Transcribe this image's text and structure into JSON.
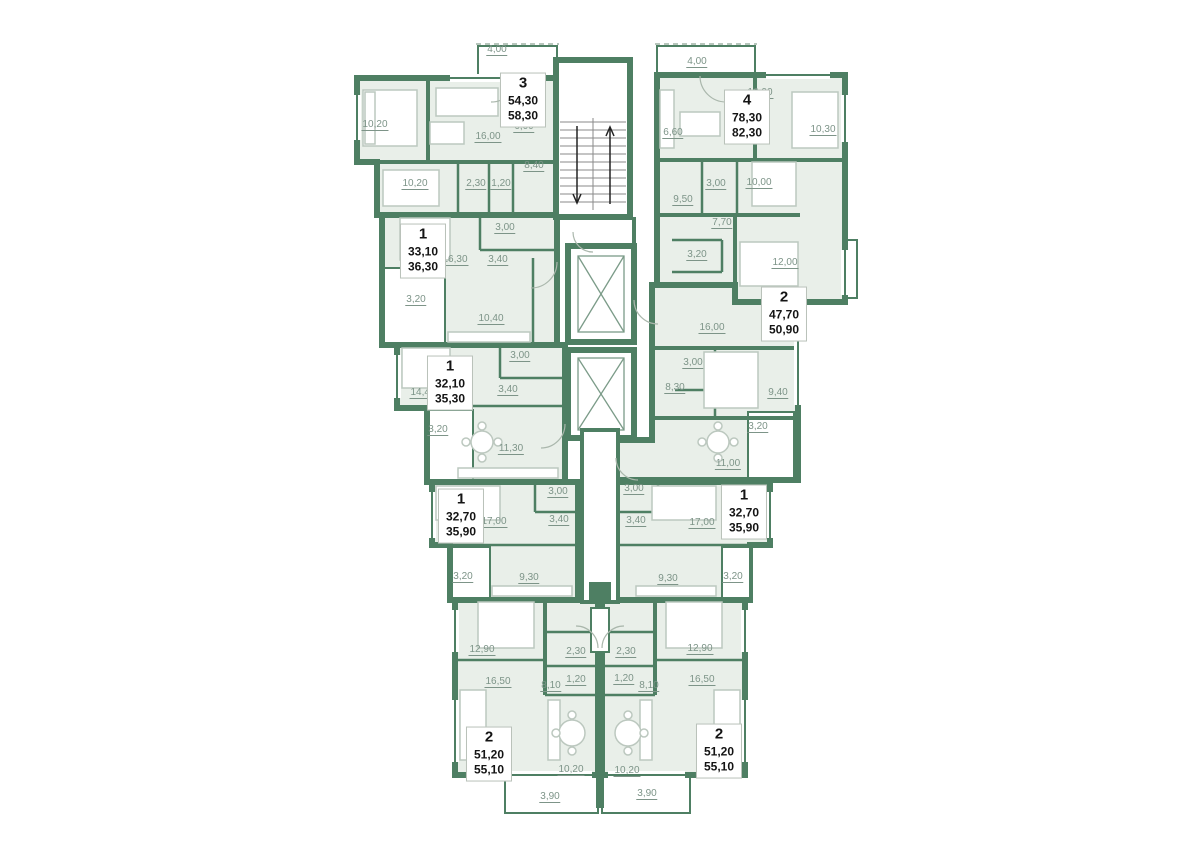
{
  "plan_title": "residential-floor-plan",
  "colors": {
    "wall": "#4e7f63",
    "room_fill": "#e9efe9",
    "dimension_text": "#7d9488",
    "label_text": "#141414",
    "label_background": "#ffffff",
    "furniture": "#bcc8bf"
  },
  "apartments": [
    {
      "number": "3",
      "area_living": "54,30",
      "area_total": "58,30",
      "x": 523,
      "y": 100
    },
    {
      "number": "4",
      "area_living": "78,30",
      "area_total": "82,30",
      "x": 747,
      "y": 117
    },
    {
      "number": "1",
      "area_living": "33,10",
      "area_total": "36,30",
      "x": 423,
      "y": 251
    },
    {
      "number": "1",
      "area_living": "32,10",
      "area_total": "35,30",
      "x": 450,
      "y": 383
    },
    {
      "number": "2",
      "area_living": "47,70",
      "area_total": "50,90",
      "x": 784,
      "y": 314
    },
    {
      "number": "1",
      "area_living": "32,70",
      "area_total": "35,90",
      "x": 461,
      "y": 516
    },
    {
      "number": "1",
      "area_living": "32,70",
      "area_total": "35,90",
      "x": 744,
      "y": 512
    },
    {
      "number": "2",
      "area_living": "51,20",
      "area_total": "55,10",
      "x": 489,
      "y": 754
    },
    {
      "number": "2",
      "area_living": "51,20",
      "area_total": "55,10",
      "x": 719,
      "y": 751
    }
  ],
  "dimensions": [
    {
      "t": "4,00",
      "x": 497,
      "y": 50
    },
    {
      "t": "10,20",
      "x": 375,
      "y": 125
    },
    {
      "t": "16,00",
      "x": 488,
      "y": 137
    },
    {
      "t": "6,00",
      "x": 524,
      "y": 127
    },
    {
      "t": "8,40",
      "x": 534,
      "y": 166
    },
    {
      "t": "10,20",
      "x": 415,
      "y": 184
    },
    {
      "t": "2,30",
      "x": 476,
      "y": 184
    },
    {
      "t": "1,20",
      "x": 501,
      "y": 184
    },
    {
      "t": "3,00",
      "x": 505,
      "y": 228
    },
    {
      "t": "16,30",
      "x": 455,
      "y": 260
    },
    {
      "t": "3,40",
      "x": 498,
      "y": 260
    },
    {
      "t": "3,20",
      "x": 416,
      "y": 300
    },
    {
      "t": "10,40",
      "x": 491,
      "y": 319
    },
    {
      "t": "3,00",
      "x": 520,
      "y": 356
    },
    {
      "t": "14,40",
      "x": 423,
      "y": 393
    },
    {
      "t": "3,40",
      "x": 508,
      "y": 390
    },
    {
      "t": "3,20",
      "x": 438,
      "y": 430
    },
    {
      "t": "11,30",
      "x": 511,
      "y": 449
    },
    {
      "t": "3,00",
      "x": 558,
      "y": 492
    },
    {
      "t": "3,40",
      "x": 559,
      "y": 520
    },
    {
      "t": "17,00",
      "x": 494,
      "y": 522
    },
    {
      "t": "3,20",
      "x": 463,
      "y": 577
    },
    {
      "t": "9,30",
      "x": 529,
      "y": 578
    },
    {
      "t": "12,90",
      "x": 482,
      "y": 650
    },
    {
      "t": "2,30",
      "x": 576,
      "y": 652
    },
    {
      "t": "1,20",
      "x": 576,
      "y": 680
    },
    {
      "t": "16,50",
      "x": 498,
      "y": 682
    },
    {
      "t": "8,10",
      "x": 551,
      "y": 686
    },
    {
      "t": "10,20",
      "x": 571,
      "y": 770
    },
    {
      "t": "3,90",
      "x": 550,
      "y": 797
    },
    {
      "t": "4,00",
      "x": 697,
      "y": 62
    },
    {
      "t": "16,00",
      "x": 760,
      "y": 93
    },
    {
      "t": "6,60",
      "x": 673,
      "y": 133
    },
    {
      "t": "10,30",
      "x": 823,
      "y": 130
    },
    {
      "t": "3,00",
      "x": 716,
      "y": 184
    },
    {
      "t": "10,00",
      "x": 759,
      "y": 183
    },
    {
      "t": "9,50",
      "x": 683,
      "y": 200
    },
    {
      "t": "7,70",
      "x": 722,
      "y": 223
    },
    {
      "t": "3,20",
      "x": 697,
      "y": 255
    },
    {
      "t": "12,00",
      "x": 785,
      "y": 263
    },
    {
      "t": "16,00",
      "x": 712,
      "y": 328
    },
    {
      "t": "3,00",
      "x": 693,
      "y": 363
    },
    {
      "t": "8,30",
      "x": 675,
      "y": 388
    },
    {
      "t": "9,40",
      "x": 778,
      "y": 393
    },
    {
      "t": "3,20",
      "x": 758,
      "y": 427
    },
    {
      "t": "11,00",
      "x": 728,
      "y": 464
    },
    {
      "t": "3,00",
      "x": 634,
      "y": 489
    },
    {
      "t": "3,40",
      "x": 636,
      "y": 521
    },
    {
      "t": "17,00",
      "x": 702,
      "y": 523
    },
    {
      "t": "9,30",
      "x": 668,
      "y": 579
    },
    {
      "t": "3,20",
      "x": 733,
      "y": 577
    },
    {
      "t": "12,90",
      "x": 700,
      "y": 649
    },
    {
      "t": "2,30",
      "x": 626,
      "y": 652
    },
    {
      "t": "1,20",
      "x": 624,
      "y": 679
    },
    {
      "t": "16,50",
      "x": 702,
      "y": 680
    },
    {
      "t": "8,10",
      "x": 649,
      "y": 686
    },
    {
      "t": "10,20",
      "x": 627,
      "y": 771
    },
    {
      "t": "3,90",
      "x": 647,
      "y": 794
    }
  ]
}
